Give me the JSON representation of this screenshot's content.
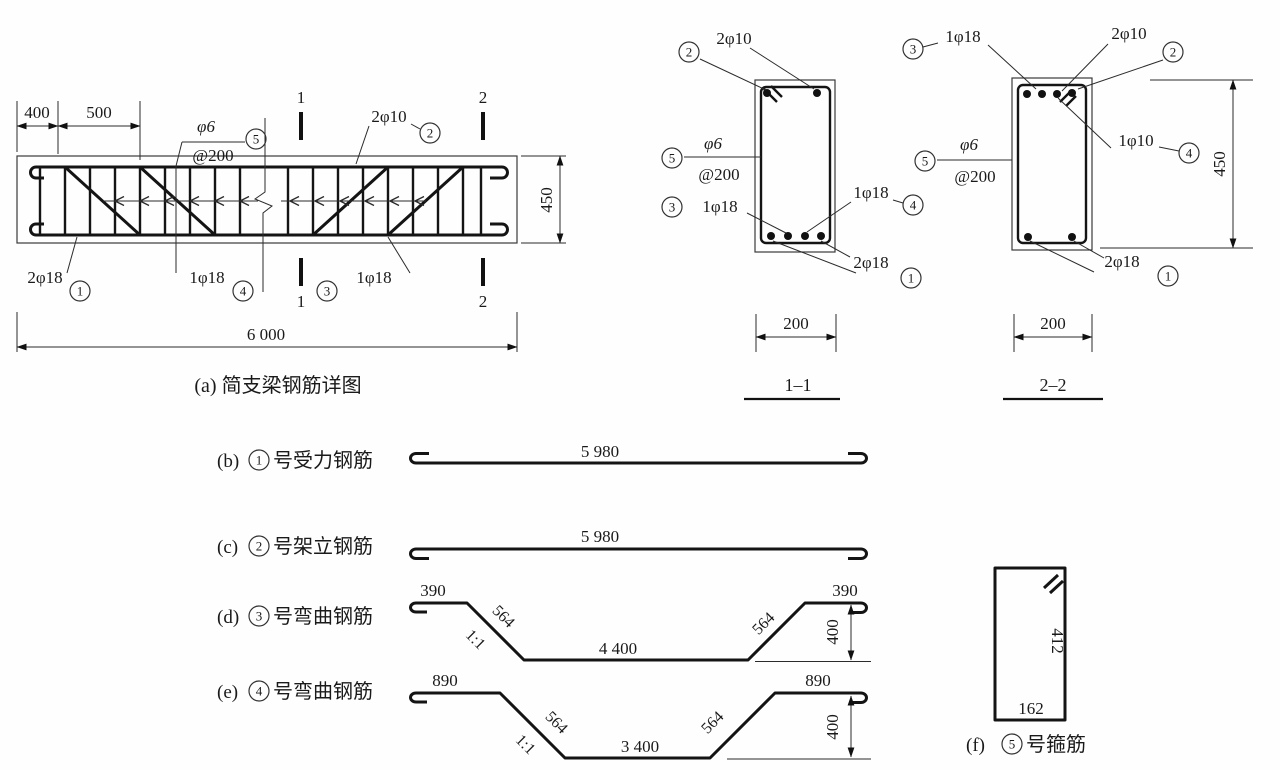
{
  "elevation": {
    "caption": "(a) 简支梁钢筋详图",
    "dims": {
      "d400": "400",
      "d500": "500",
      "d450": "450",
      "d6000": "6 000"
    },
    "stirrup": {
      "label_top": "φ6",
      "label_bottom": "@200",
      "num": "5"
    },
    "top_bar": {
      "text": "2φ10",
      "num": "2"
    },
    "bottom_labels": [
      {
        "text": "2φ18",
        "num": "1"
      },
      {
        "text": "1φ18",
        "num": "4"
      },
      {
        "text": "1φ18",
        "num": "3"
      }
    ],
    "section_marks": {
      "s1": "1",
      "s2": "2"
    }
  },
  "section11": {
    "title": "1–1",
    "width_dim": "200",
    "top": {
      "num": "2",
      "text": "2φ10"
    },
    "stirrup": {
      "num": "5",
      "top": "φ6",
      "bottom": "@200"
    },
    "left": {
      "num": "3",
      "text": "1φ18"
    },
    "right": {
      "num": "4",
      "text": "1φ18"
    },
    "bottom": {
      "num": "1",
      "text": "2φ18"
    }
  },
  "section22": {
    "title": "2–2",
    "width_dim": "200",
    "height_dim": "450",
    "top_left": {
      "num": "3",
      "text": "1φ18"
    },
    "top_right": {
      "num": "2",
      "text": "2φ10"
    },
    "stirrup": {
      "num": "5",
      "top": "φ6",
      "bottom": "@200"
    },
    "right": {
      "num": "4",
      "text": "1φ10"
    },
    "bottom": {
      "num": "1",
      "text": "2φ18"
    }
  },
  "bars": {
    "b": {
      "prefix": "(b)",
      "num": "1",
      "suffix": "号受力钢筋",
      "length": "5 980"
    },
    "c": {
      "prefix": "(c)",
      "num": "2",
      "suffix": "号架立钢筋",
      "length": "5 980"
    },
    "d": {
      "prefix": "(d)",
      "num": "3",
      "suffix": "号弯曲钢筋",
      "end_left": "390",
      "slope_left": "564",
      "slope_ratio": "1:1",
      "mid": "4 400",
      "slope_right": "564",
      "end_right": "390",
      "rise": "400"
    },
    "e": {
      "prefix": "(e)",
      "num": "4",
      "suffix": "号弯曲钢筋",
      "end_left": "890",
      "slope_left": "564",
      "slope_ratio": "1:1",
      "mid": "3 400",
      "slope_right": "564",
      "end_right": "890",
      "rise": "400"
    },
    "f": {
      "prefix": "(f)",
      "num": "5",
      "suffix": "号箍筋",
      "side": "412",
      "bottom": "162"
    }
  }
}
